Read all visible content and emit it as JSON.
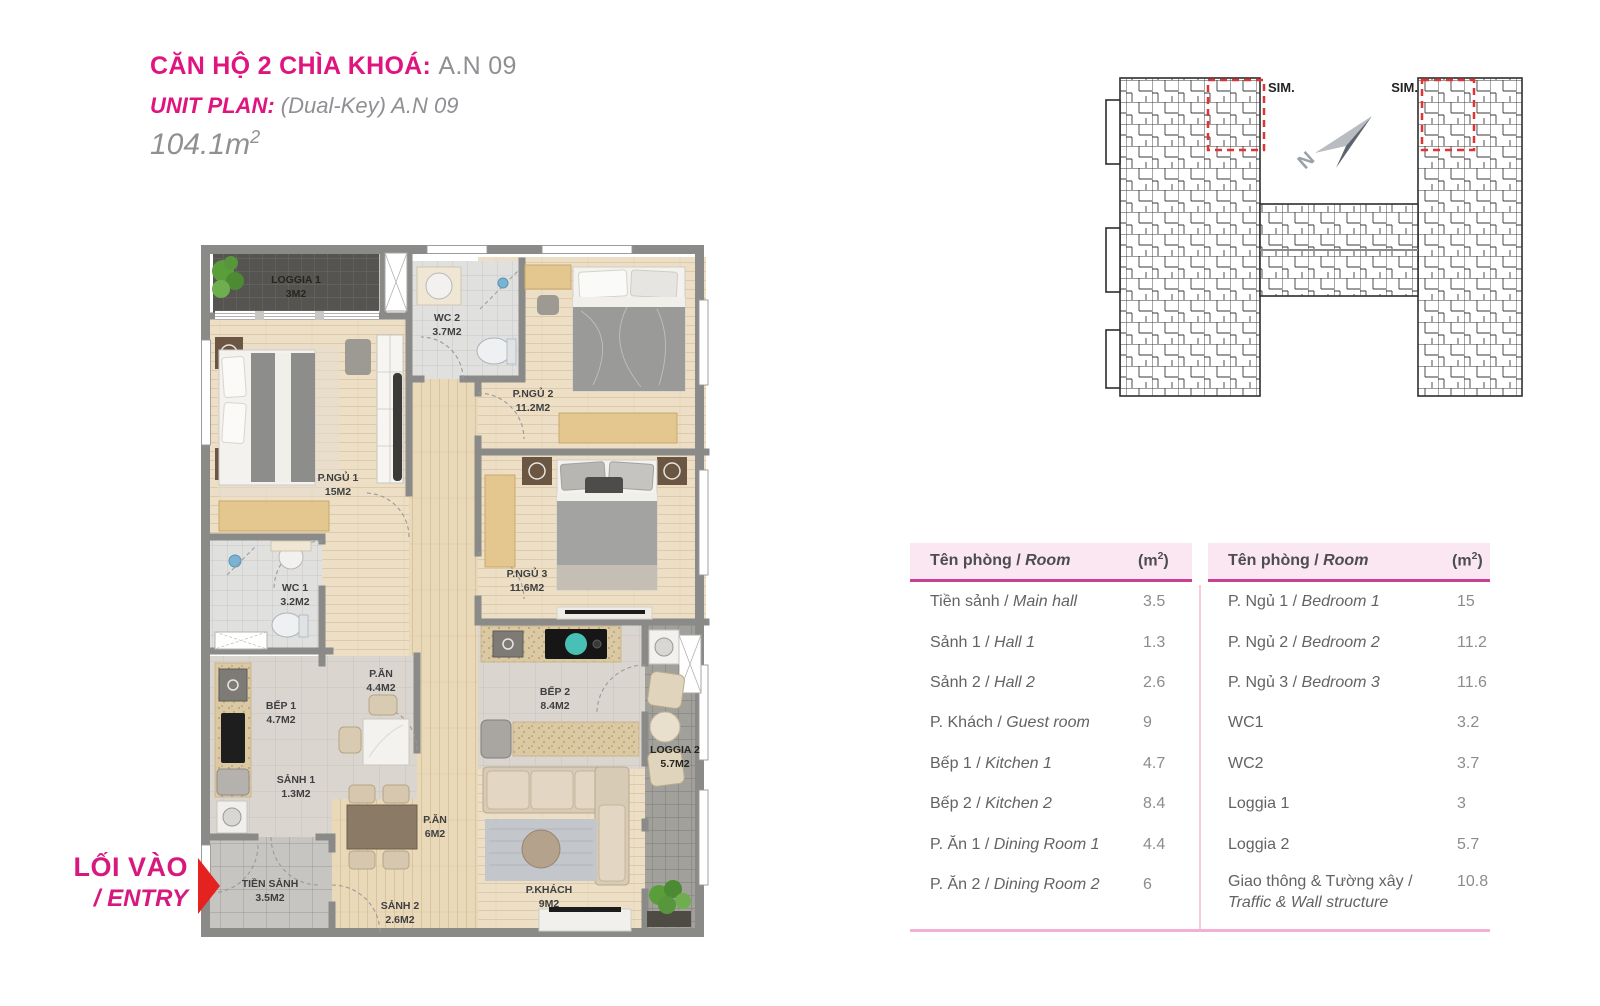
{
  "header": {
    "title_label": "CĂN HỘ 2 CHÌA KHOÁ:",
    "title_value": "A.N 09",
    "subtitle_label": "UNIT PLAN:",
    "subtitle_value": "(Dual-Key) A.N 09",
    "area_value": "104.1m",
    "area_sup": "2"
  },
  "entry_marker": {
    "line1": "LỐI VÀO",
    "line2": "/ ENTRY"
  },
  "key_plan": {
    "sim_left": "SIM.",
    "sim_right": "SIM.",
    "north_letter": "N"
  },
  "floor_plan": {
    "rooms": [
      {
        "name": "LOGGIA 1",
        "area": "3M2"
      },
      {
        "name": "WC 2",
        "area": "3.7M2"
      },
      {
        "name": "P.NGỦ 2",
        "area": "11.2M2"
      },
      {
        "name": "P.NGỦ 1",
        "area": "15M2"
      },
      {
        "name": "WC 1",
        "area": "3.2M2"
      },
      {
        "name": "P.NGỦ 3",
        "area": "11.6M2"
      },
      {
        "name": "BẾP 1",
        "area": "4.7M2"
      },
      {
        "name": "P.ĂN",
        "area": "4.4M2"
      },
      {
        "name": "SẢNH 1",
        "area": "1.3M2"
      },
      {
        "name": "BẾP 2",
        "area": "8.4M2"
      },
      {
        "name": "TIỀN SẢNH",
        "area": "3.5M2"
      },
      {
        "name": "SẢNH 2",
        "area": "2.6M2"
      },
      {
        "name": "P.ĂN",
        "area": "6M2"
      },
      {
        "name": "P.KHÁCH",
        "area": "9M2"
      },
      {
        "name": "LOGGIA 2",
        "area": "5.7M2"
      }
    ]
  },
  "area_table": {
    "header": {
      "room_label": "Tên phòng / ",
      "room_label_italic": "Room",
      "unit_pre": "(m",
      "unit_sup": "2",
      "unit_post": ")"
    },
    "left_rows": [
      {
        "vi": "Tiền sảnh / ",
        "en": "Main hall",
        "val": "3.5"
      },
      {
        "vi": "Sảnh 1 / ",
        "en": "Hall 1",
        "val": "1.3"
      },
      {
        "vi": "Sảnh 2 / ",
        "en": "Hall 2",
        "val": "2.6"
      },
      {
        "vi": "P. Khách / ",
        "en": "Guest room",
        "val": "9"
      },
      {
        "vi": "Bếp 1 / ",
        "en": "Kitchen 1",
        "val": "4.7"
      },
      {
        "vi": "Bếp 2 / ",
        "en": "Kitchen 2",
        "val": "8.4"
      },
      {
        "vi": "P. Ăn 1 / ",
        "en": "Dining Room 1",
        "val": "4.4"
      },
      {
        "vi": "P. Ăn 2 / ",
        "en": "Dining Room 2",
        "val": "6"
      }
    ],
    "right_rows": [
      {
        "vi": "P. Ngủ 1 / ",
        "en": "Bedroom 1",
        "val": "15"
      },
      {
        "vi": "P. Ngủ 2 / ",
        "en": "Bedroom 2",
        "val": "11.2"
      },
      {
        "vi": "P. Ngủ 3 / ",
        "en": "Bedroom 3",
        "val": "11.6"
      },
      {
        "vi": "WC1",
        "en": "",
        "val": "3.2"
      },
      {
        "vi": "WC2",
        "en": "",
        "val": "3.7"
      },
      {
        "vi": "Loggia 1",
        "en": "",
        "val": "3"
      },
      {
        "vi": "Loggia 2",
        "en": "",
        "val": "5.7"
      },
      {
        "vi": "Giao thông & Tường xây /",
        "en": "Traffic & Wall structure",
        "val": "10.8"
      }
    ]
  },
  "colors": {
    "brand_magenta": "#e0147f",
    "gray_text": "#8e9093",
    "table_header_bg": "#fae7f2",
    "table_rule": "#c94090",
    "table_bottom_rule": "#f2b1d2",
    "highlight_red": "#e03434",
    "entry_arrow_red": "#e42320",
    "wall_gray": "#8a8a88"
  }
}
